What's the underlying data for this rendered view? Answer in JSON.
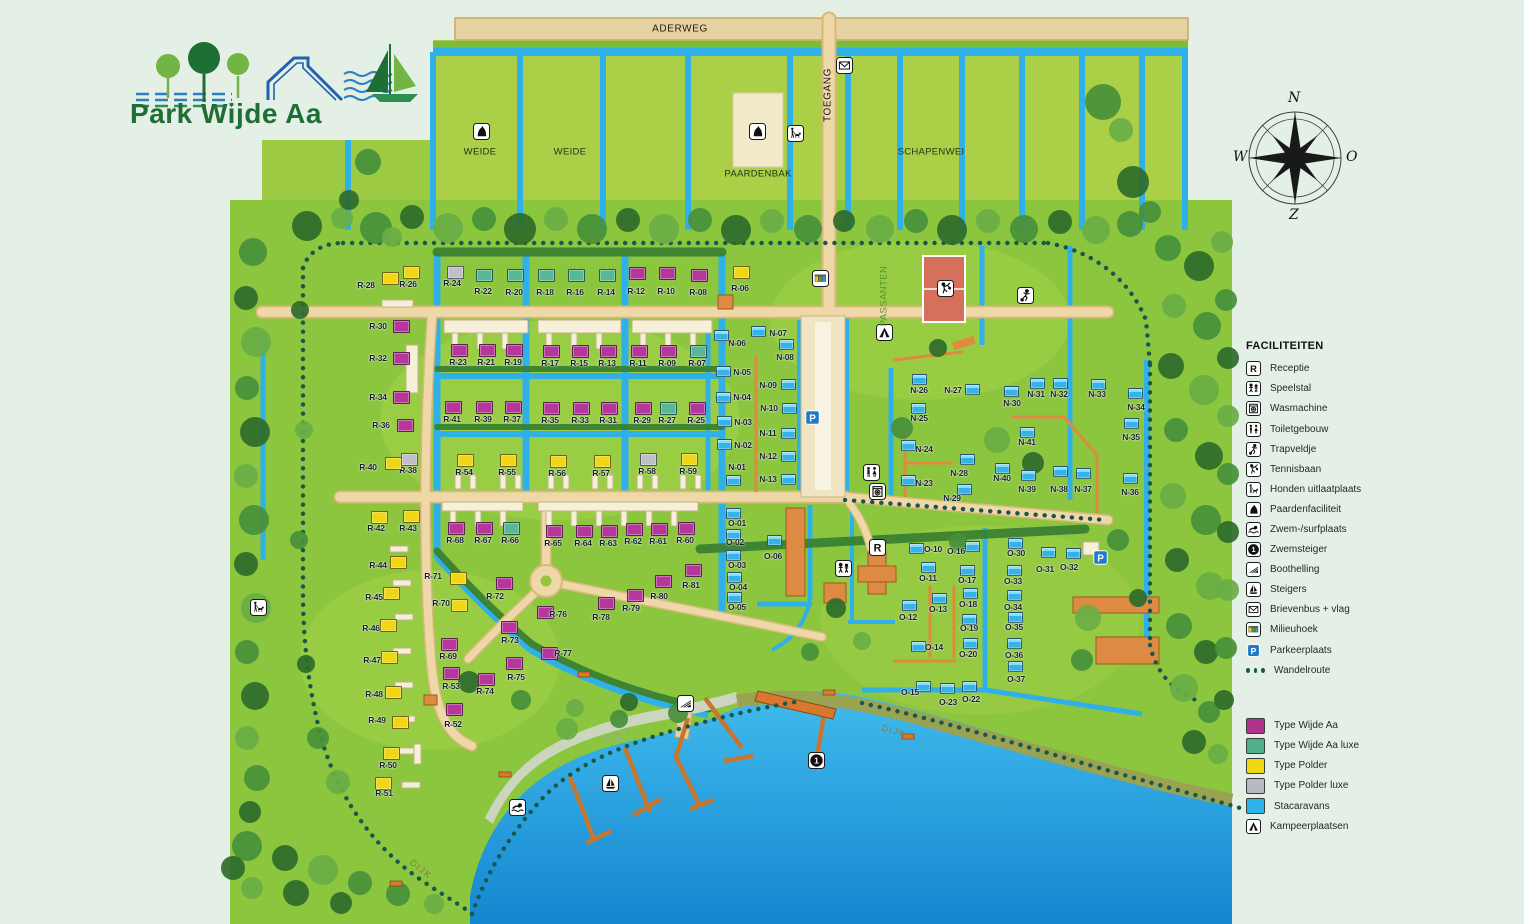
{
  "logo": {
    "title": "Park Wijde Aa"
  },
  "compass": {
    "n": "N",
    "o": "O",
    "z": "Z",
    "w": "W"
  },
  "legend": {
    "title": "FACILITEITEN",
    "items": [
      {
        "icon": "receptie",
        "label": "Receptie"
      },
      {
        "icon": "speelstal",
        "label": "Speelstal"
      },
      {
        "icon": "wasmachine",
        "label": "Wasmachine"
      },
      {
        "icon": "toiletgebouw",
        "label": "Toiletgebouw"
      },
      {
        "icon": "trapveldje",
        "label": "Trapveldje"
      },
      {
        "icon": "tennisbaan",
        "label": "Tennisbaan"
      },
      {
        "icon": "honden",
        "label": "Honden uitlaatplaats"
      },
      {
        "icon": "paarden",
        "label": "Paardenfaciliteit"
      },
      {
        "icon": "zwem",
        "label": "Zwem-/surfplaats"
      },
      {
        "icon": "zwemsteiger",
        "label": "Zwemsteiger"
      },
      {
        "icon": "boothelling",
        "label": "Boothelling"
      },
      {
        "icon": "steigers",
        "label": "Steigers"
      },
      {
        "icon": "brievenbus",
        "label": "Brievenbus + vlag"
      },
      {
        "icon": "milieuhoek",
        "label": "Milieuhoek"
      },
      {
        "icon": "parkeerplaats",
        "label": "Parkeerplaats"
      },
      {
        "icon": "wandelroute",
        "label": "Wandelroute"
      }
    ],
    "types": [
      {
        "color": "#b0338e",
        "label": "Type Wijde Aa"
      },
      {
        "color": "#50b08c",
        "label": "Type Wijde Aa luxe"
      },
      {
        "color": "#f0d613",
        "label": "Type Polder"
      },
      {
        "color": "#b9b9c1",
        "label": "Type Polder luxe"
      },
      {
        "color": "#2fb3e6",
        "label": "Stacaravans"
      },
      {
        "icon": "kampeer",
        "label": "Kampeerplaatsen"
      }
    ]
  },
  "areas": [
    {
      "label": "ADERWEG",
      "x": 680,
      "y": 29,
      "cls": "al-road",
      "rot": 0
    },
    {
      "label": "WEIDE",
      "x": 480,
      "y": 152,
      "cls": "al-field",
      "rot": 0
    },
    {
      "label": "WEIDE",
      "x": 570,
      "y": 152,
      "cls": "al-field",
      "rot": 0
    },
    {
      "label": "PAARDENBAK",
      "x": 758,
      "y": 174,
      "cls": "al-field",
      "rot": 0
    },
    {
      "label": "TOEGANG",
      "x": 828,
      "y": 95,
      "cls": "al-vert",
      "rot": -90
    },
    {
      "label": "SCHAPENWEI",
      "x": 931,
      "y": 152,
      "cls": "al-field",
      "rot": 0
    },
    {
      "label": "PASSANTEN",
      "x": 884,
      "y": 296,
      "cls": "al-pass",
      "rot": -90
    },
    {
      "label": "RIET",
      "x": 618,
      "y": 737,
      "cls": "al-riet",
      "rot": -14
    },
    {
      "label": "DIJK",
      "x": 894,
      "y": 731,
      "cls": "al-dijk",
      "rot": 16
    },
    {
      "label": "DIJK",
      "x": 421,
      "y": 869,
      "cls": "al-dijk",
      "rot": 38
    }
  ],
  "map_icons": [
    [
      "paarden",
      481,
      131
    ],
    [
      "paarden",
      757,
      131
    ],
    [
      "honden",
      795,
      133
    ],
    [
      "brievenbus",
      844,
      65
    ],
    [
      "milieuhoek",
      820,
      278
    ],
    [
      "kampeer",
      884,
      332
    ],
    [
      "tennisbaan",
      945,
      288
    ],
    [
      "trapveldje",
      1025,
      295
    ],
    [
      "toiletgebouw",
      871,
      472
    ],
    [
      "wasmachine",
      877,
      491
    ],
    [
      "receptie",
      877,
      547
    ],
    [
      "speelstal",
      843,
      568
    ],
    [
      "parkeerplaats",
      812,
      417
    ],
    [
      "parkeerplaats",
      1100,
      557
    ],
    [
      "honden",
      258,
      607
    ],
    [
      "boothelling",
      685,
      703
    ],
    [
      "steigers",
      610,
      783
    ],
    [
      "zwem",
      517,
      807
    ],
    [
      "zwemsteiger",
      816,
      760
    ]
  ],
  "plots": [
    [
      "R-06",
      "p",
      740,
      271,
      740,
      288
    ],
    [
      "R-08",
      "w",
      698,
      274,
      698,
      292
    ],
    [
      "R-10",
      "w",
      666,
      272,
      666,
      291
    ],
    [
      "R-12",
      "w",
      636,
      272,
      636,
      291
    ],
    [
      "R-14",
      "l",
      606,
      274,
      606,
      292
    ],
    [
      "R-16",
      "l",
      575,
      274,
      575,
      292
    ],
    [
      "R-18",
      "l",
      545,
      274,
      545,
      292
    ],
    [
      "R-20",
      "l",
      514,
      274,
      514,
      292
    ],
    [
      "R-22",
      "l",
      483,
      274,
      483,
      291
    ],
    [
      "R-24",
      "x",
      454,
      271,
      452,
      283
    ],
    [
      "R-26",
      "p",
      410,
      271,
      408,
      284
    ],
    [
      "R-28",
      "p",
      389,
      277,
      366,
      285
    ],
    [
      "R-30",
      "w",
      400,
      325,
      378,
      326
    ],
    [
      "R-32",
      "w",
      400,
      357,
      378,
      358
    ],
    [
      "R-34",
      "w",
      400,
      396,
      378,
      397
    ],
    [
      "R-36",
      "w",
      404,
      424,
      381,
      425
    ],
    [
      "R-38",
      "x",
      408,
      458,
      408,
      470
    ],
    [
      "R-40",
      "p",
      392,
      462,
      368,
      467
    ],
    [
      "R-07",
      "l",
      697,
      350,
      697,
      363
    ],
    [
      "R-09",
      "w",
      667,
      350,
      667,
      363
    ],
    [
      "R-11",
      "w",
      638,
      350,
      638,
      363
    ],
    [
      "R-13",
      "w",
      607,
      350,
      607,
      363
    ],
    [
      "R-15",
      "w",
      579,
      350,
      579,
      363
    ],
    [
      "R-17",
      "w",
      550,
      350,
      550,
      363
    ],
    [
      "R-19",
      "w",
      513,
      349,
      513,
      362
    ],
    [
      "R-21",
      "w",
      486,
      349,
      486,
      362
    ],
    [
      "R-23",
      "w",
      458,
      349,
      458,
      362
    ],
    [
      "R-25",
      "w",
      696,
      407,
      696,
      420
    ],
    [
      "R-27",
      "l",
      667,
      407,
      667,
      420
    ],
    [
      "R-29",
      "w",
      642,
      407,
      642,
      420
    ],
    [
      "R-31",
      "w",
      608,
      407,
      608,
      420
    ],
    [
      "R-33",
      "w",
      580,
      407,
      580,
      420
    ],
    [
      "R-35",
      "w",
      550,
      407,
      550,
      420
    ],
    [
      "R-37",
      "w",
      512,
      406,
      512,
      419
    ],
    [
      "R-39",
      "w",
      483,
      406,
      483,
      419
    ],
    [
      "R-41",
      "w",
      452,
      406,
      452,
      419
    ],
    [
      "R-54",
      "p",
      464,
      459,
      464,
      472
    ],
    [
      "R-55",
      "p",
      507,
      459,
      507,
      472
    ],
    [
      "R-56",
      "p",
      557,
      460,
      557,
      473
    ],
    [
      "R-57",
      "p",
      601,
      460,
      601,
      473
    ],
    [
      "R-58",
      "x",
      647,
      458,
      647,
      471
    ],
    [
      "R-59",
      "p",
      688,
      458,
      688,
      471
    ],
    [
      "R-60",
      "w",
      685,
      527,
      685,
      540
    ],
    [
      "R-61",
      "w",
      658,
      528,
      658,
      541
    ],
    [
      "R-62",
      "w",
      633,
      528,
      633,
      541
    ],
    [
      "R-63",
      "w",
      608,
      530,
      608,
      543
    ],
    [
      "R-64",
      "w",
      583,
      530,
      583,
      543
    ],
    [
      "R-65",
      "w",
      553,
      530,
      553,
      543
    ],
    [
      "R-66",
      "l",
      510,
      527,
      510,
      540
    ],
    [
      "R-67",
      "w",
      483,
      527,
      483,
      540
    ],
    [
      "R-68",
      "w",
      455,
      527,
      455,
      540
    ],
    [
      "R-42",
      "p",
      378,
      516,
      376,
      528
    ],
    [
      "R-43",
      "p",
      410,
      515,
      408,
      528
    ],
    [
      "R-44",
      "p",
      397,
      561,
      378,
      565
    ],
    [
      "R-45",
      "p",
      390,
      592,
      374,
      597
    ],
    [
      "R-46",
      "p",
      387,
      624,
      371,
      628
    ],
    [
      "R-47",
      "p",
      388,
      656,
      372,
      660
    ],
    [
      "R-48",
      "p",
      392,
      691,
      374,
      694
    ],
    [
      "R-49",
      "p",
      399,
      721,
      377,
      720
    ],
    [
      "R-50",
      "p",
      390,
      752,
      388,
      765
    ],
    [
      "R-51",
      "p",
      382,
      782,
      384,
      793
    ],
    [
      "R-52",
      "w",
      453,
      708,
      453,
      724
    ],
    [
      "R-53",
      "w",
      450,
      672,
      451,
      686
    ],
    [
      "R-69",
      "w",
      448,
      643,
      448,
      656
    ],
    [
      "R-70",
      "p",
      458,
      604,
      441,
      603
    ],
    [
      "R-71",
      "p",
      457,
      577,
      433,
      576
    ],
    [
      "R-72",
      "w",
      503,
      582,
      495,
      596
    ],
    [
      "R-73",
      "w",
      508,
      626,
      510,
      640
    ],
    [
      "R-74",
      "w",
      485,
      678,
      485,
      691
    ],
    [
      "R-75",
      "w",
      513,
      662,
      516,
      677
    ],
    [
      "R-76",
      "w",
      544,
      611,
      558,
      614
    ],
    [
      "R-77",
      "w",
      548,
      652,
      563,
      653
    ],
    [
      "R-78",
      "w",
      605,
      602,
      601,
      617
    ],
    [
      "R-79",
      "w",
      634,
      594,
      631,
      608
    ],
    [
      "R-80",
      "w",
      662,
      580,
      659,
      596
    ],
    [
      "R-81",
      "w",
      692,
      569,
      691,
      585
    ],
    [
      "N-01",
      "s",
      732,
      479,
      737,
      467
    ],
    [
      "N-02",
      "s",
      723,
      443,
      743,
      445
    ],
    [
      "N-03",
      "s",
      723,
      420,
      743,
      422
    ],
    [
      "N-04",
      "s",
      722,
      396,
      742,
      397
    ],
    [
      "N-05",
      "s",
      722,
      370,
      742,
      372
    ],
    [
      "N-06",
      "s",
      720,
      334,
      737,
      343
    ],
    [
      "N-07",
      "s",
      757,
      330,
      778,
      333
    ],
    [
      "N-08",
      "s",
      785,
      343,
      785,
      357
    ],
    [
      "N-09",
      "s",
      787,
      383,
      768,
      385
    ],
    [
      "N-10",
      "s",
      788,
      407,
      769,
      408
    ],
    [
      "N-11",
      "s",
      787,
      432,
      768,
      433
    ],
    [
      "N-12",
      "s",
      787,
      455,
      768,
      456
    ],
    [
      "N-13",
      "s",
      787,
      478,
      768,
      479
    ],
    [
      "N-23",
      "s",
      907,
      479,
      924,
      483
    ],
    [
      "N-24",
      "s",
      907,
      444,
      924,
      449
    ],
    [
      "N-25",
      "s",
      917,
      407,
      919,
      418
    ],
    [
      "N-26",
      "s",
      918,
      378,
      919,
      390
    ],
    [
      "N-27",
      "s",
      971,
      388,
      953,
      390
    ],
    [
      "N-28",
      "s",
      966,
      458,
      959,
      473
    ],
    [
      "N-29",
      "s",
      963,
      488,
      952,
      498
    ],
    [
      "N-30",
      "s",
      1010,
      390,
      1012,
      403
    ],
    [
      "N-31",
      "s",
      1036,
      382,
      1036,
      394
    ],
    [
      "N-32",
      "s",
      1059,
      382,
      1059,
      394
    ],
    [
      "N-33",
      "s",
      1097,
      383,
      1097,
      394
    ],
    [
      "N-34",
      "s",
      1134,
      392,
      1136,
      407
    ],
    [
      "N-35",
      "s",
      1130,
      422,
      1131,
      437
    ],
    [
      "N-36",
      "s",
      1129,
      477,
      1130,
      492
    ],
    [
      "N-37",
      "s",
      1082,
      472,
      1083,
      489
    ],
    [
      "N-38",
      "s",
      1059,
      470,
      1059,
      489
    ],
    [
      "N-39",
      "s",
      1027,
      474,
      1027,
      489
    ],
    [
      "N-40",
      "s",
      1001,
      467,
      1002,
      478
    ],
    [
      "N-41",
      "s",
      1026,
      431,
      1027,
      442
    ],
    [
      "O-01",
      "s",
      732,
      512,
      737,
      523
    ],
    [
      "O-02",
      "s",
      732,
      533,
      735,
      542
    ],
    [
      "O-03",
      "s",
      732,
      554,
      737,
      565
    ],
    [
      "O-04",
      "s",
      733,
      576,
      738,
      587
    ],
    [
      "O-05",
      "s",
      733,
      596,
      737,
      607
    ],
    [
      "O-06",
      "s",
      773,
      539,
      773,
      556
    ],
    [
      "O-10",
      "s",
      915,
      547,
      933,
      549
    ],
    [
      "O-11",
      "s",
      927,
      566,
      928,
      578
    ],
    [
      "O-12",
      "s",
      908,
      604,
      908,
      617
    ],
    [
      "O-13",
      "s",
      938,
      597,
      938,
      609
    ],
    [
      "O-14",
      "s",
      917,
      645,
      934,
      647
    ],
    [
      "O-15",
      "s",
      922,
      685,
      910,
      692
    ],
    [
      "O-16",
      "s",
      971,
      545,
      956,
      551
    ],
    [
      "O-17",
      "s",
      966,
      569,
      967,
      580
    ],
    [
      "O-18",
      "s",
      969,
      592,
      968,
      604
    ],
    [
      "O-19",
      "s",
      968,
      618,
      969,
      628
    ],
    [
      "O-20",
      "s",
      969,
      642,
      968,
      654
    ],
    [
      "O-22",
      "s",
      968,
      685,
      971,
      699
    ],
    [
      "O-23",
      "s",
      946,
      687,
      948,
      702
    ],
    [
      "O-30",
      "s",
      1014,
      542,
      1016,
      553
    ],
    [
      "O-31",
      "s",
      1047,
      551,
      1045,
      569
    ],
    [
      "O-32",
      "s",
      1072,
      552,
      1069,
      567
    ],
    [
      "O-33",
      "s",
      1013,
      569,
      1013,
      581
    ],
    [
      "O-34",
      "s",
      1013,
      594,
      1013,
      607
    ],
    [
      "O-35",
      "s",
      1014,
      616,
      1014,
      627
    ],
    [
      "O-36",
      "s",
      1013,
      642,
      1014,
      655
    ],
    [
      "O-37",
      "s",
      1014,
      665,
      1016,
      679
    ]
  ]
}
